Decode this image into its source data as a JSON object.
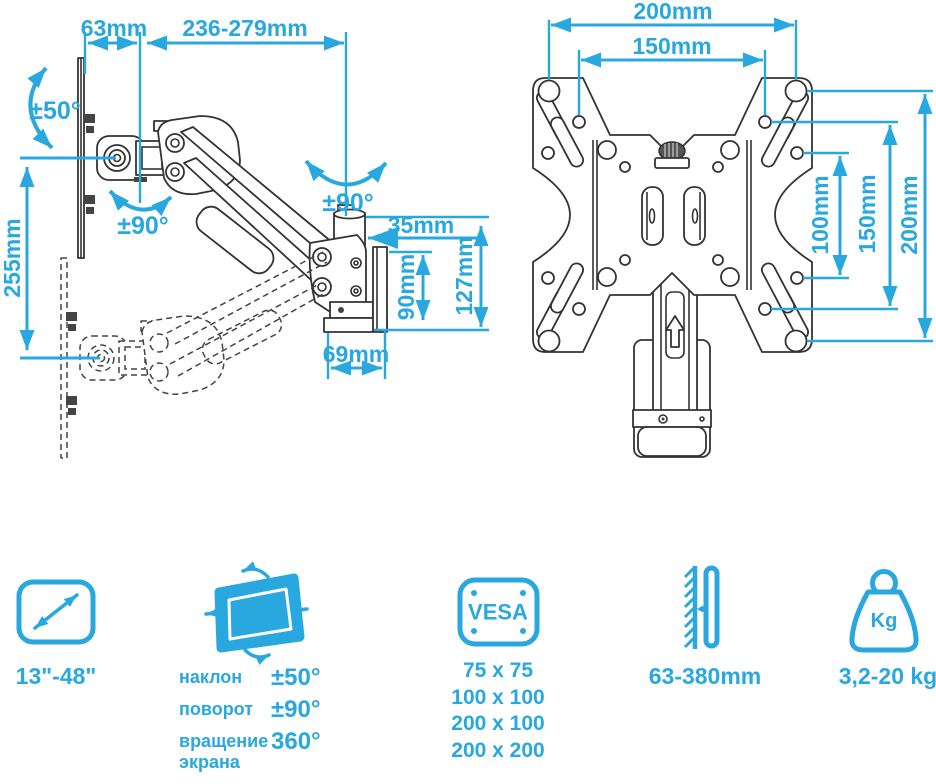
{
  "colors": {
    "accent": "#29a8e0",
    "line_art": "#333333",
    "background": "#ffffff"
  },
  "side_view": {
    "dim_wall_offset": "63mm",
    "dim_extension": "236-279mm",
    "dim_tilt": "±50°",
    "dim_swivel_elbow": "±90°",
    "dim_swivel_head": "±90°",
    "dim_height_between_positions": "255mm",
    "dim_head_depth": "35mm",
    "dim_plate_height": "90mm",
    "dim_total_head_height": "127mm",
    "dim_base_depth": "69mm"
  },
  "rear_view": {
    "dim_hole_width_outer": "200mm",
    "dim_hole_width_inner": "150mm",
    "dim_hole_height_100": "100mm",
    "dim_hole_height_150": "150mm",
    "dim_hole_height_200": "200mm"
  },
  "specs": {
    "screen_size": {
      "label": "13\"-48\""
    },
    "movement": {
      "rows": [
        {
          "label": "наклон",
          "value": "±50°"
        },
        {
          "label": "поворот",
          "value": "±90°"
        },
        {
          "label": "вращение экрана",
          "value": "360°"
        }
      ]
    },
    "vesa": {
      "title": "VESA",
      "sizes": [
        "75 x 75",
        "100 x 100",
        "200 x 100",
        "200 x 200"
      ]
    },
    "wall_distance": {
      "label": "63-380mm"
    },
    "max_weight": {
      "label": "3,2-20 kg",
      "unit": "Kg"
    }
  }
}
